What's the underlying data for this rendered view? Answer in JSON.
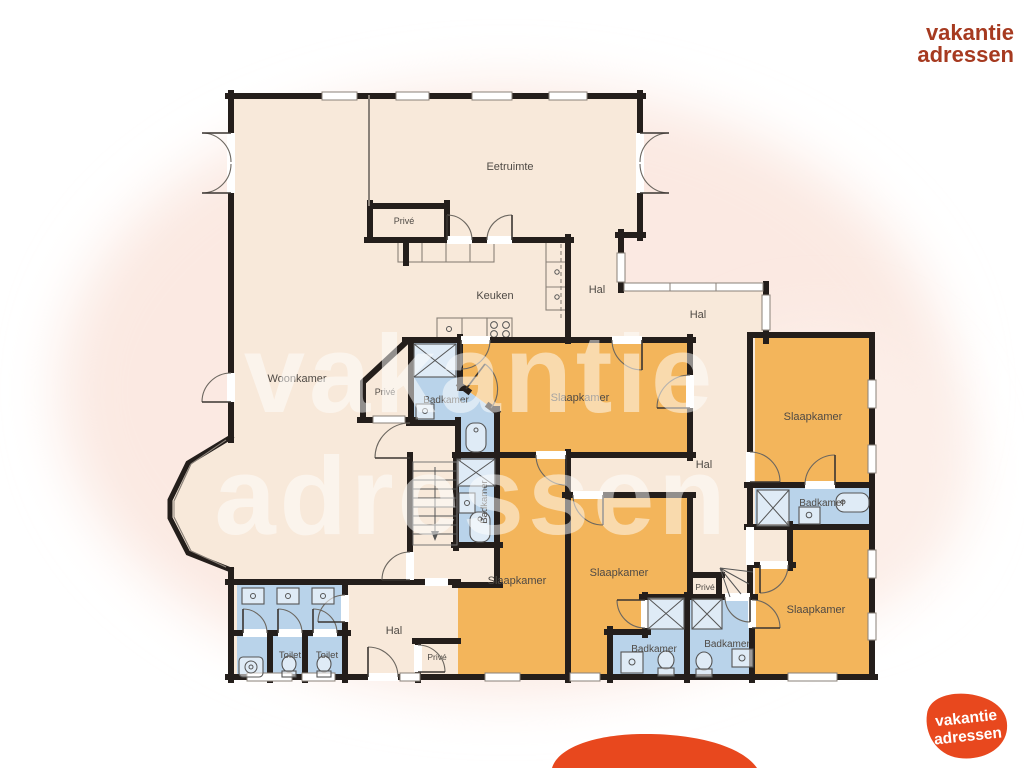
{
  "palette": {
    "wall": "#241e1b",
    "floor": "#f8e9da",
    "bedroom": "#f3b55b",
    "bathroom": "#b9d3ea",
    "halo": "#fbe9e2",
    "label": "#4f4a45"
  },
  "rooms": {
    "eetruimte": "Eetruimte",
    "woonkamer": "Woonkamer",
    "keuken": "Keuken",
    "hal_kitchen": "Hal",
    "hal_glazed": "Hal",
    "hal_corridor": "Hal",
    "hal_entry": "Hal",
    "prive_top": "Privé",
    "prive_pentagon": "Privé",
    "prive_corridor": "Privé",
    "prive_entry": "Privé",
    "slaapkamer_center": "Slaapkamer",
    "slaapkamer_left": "Slaapkamer",
    "slaapkamer_mid": "Slaapkamer",
    "slaapkamer_right_top": "Slaapkamer",
    "slaapkamer_right_bottom": "Slaapkamer",
    "badkamer_center_left": "Badkamer",
    "badkamer_stairs": "Badkamer",
    "badkamer_mid_left": "Badkamer",
    "badkamer_mid_right": "Badkamer",
    "badkamer_right": "Badkamer",
    "toilet_1": "Toilet",
    "toilet_2": "Toilet"
  },
  "branding": {
    "watermark": {
      "line1": "vakantie",
      "line2": "adressen"
    },
    "header": {
      "line1": "vakantie",
      "line2": "adressen",
      "color": "#a63a20"
    },
    "logo": {
      "line1": "vakantie",
      "line2": "adressen",
      "blob_color": "#e8481e",
      "text_color": "#ffffff"
    }
  }
}
